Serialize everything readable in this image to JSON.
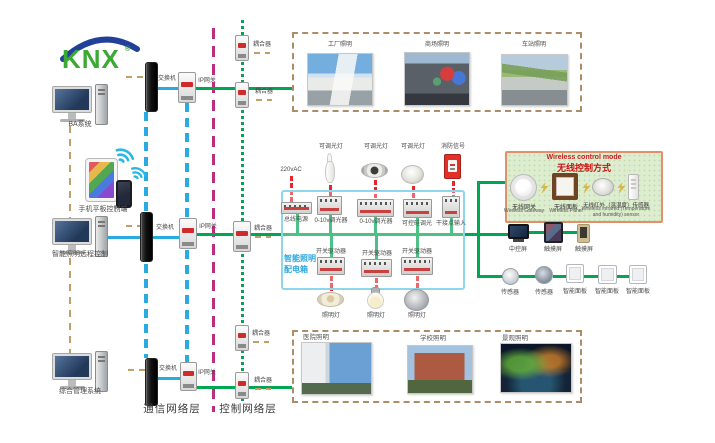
{
  "logo": {
    "text": "KNX",
    "registered": "®"
  },
  "left": {
    "ba_system": "BA系统",
    "mobile_control": "手机平板控制端",
    "remote_control": "智能照明远程控制",
    "management": "综合管理系统"
  },
  "layer_labels": {
    "communication": "通信网络层",
    "control": "控制网络层"
  },
  "network": {
    "switch": "交换机",
    "ip_gateway": "IP网关",
    "coupler": "耦合器"
  },
  "dist_box": {
    "name_line1": "智能照明",
    "name_line2": "配电箱",
    "power_in": "220vAC",
    "bus_power": "总线电源",
    "dimmer_0_10v": "0-10v调光器",
    "scr_dimmer": "可控硅调光",
    "dry_contact": "干接点输入",
    "switch_driver": "开关驱动器",
    "dimmable_lamp": "可调光灯",
    "fire_signal": "消防信号",
    "lamp": "照明灯"
  },
  "wireless": {
    "title_en": "Wireless control mode",
    "title_cn": "无线控制方式",
    "gateway_cn": "无线网关",
    "gateway_en": "Wireless Gateway",
    "panel_cn": "无线面板",
    "panel_en": "Wireless Panel",
    "sensor_cn": "无线红外（温湿度）传感器",
    "sensor_en": "Wireless infrared (Temperature and humidity) sensor"
  },
  "terminals": {
    "central_screen": "中控屏",
    "touch_screen": "触摸屏",
    "sensor": "传感器",
    "smart_panel": "智能面板"
  },
  "venues_top": [
    "工厂照明",
    "商场照明",
    "车站照明"
  ],
  "venues_bottom": [
    "医院照明",
    "学校照明",
    "景观照明"
  ],
  "colors": {
    "lan_blue": "#29abe2",
    "knx_green": "#00a651",
    "layer_divider_purple": "#bb2d7f",
    "link_tan": "#c0a06a",
    "power_red": "#e8252a",
    "dist_box_border": "#8ed7ea",
    "wireless_border": "#e2906a",
    "wireless_bg": "#ddedcf",
    "logo_green": "#3aaa35",
    "logo_blue": "#20409a"
  }
}
